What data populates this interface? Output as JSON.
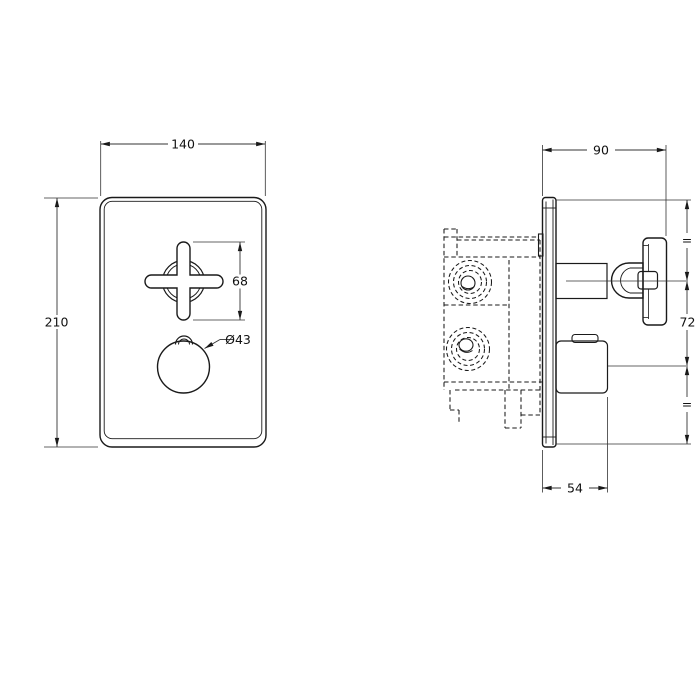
{
  "drawing": {
    "type": "technical-dimension-drawing",
    "subject": "concealed thermostatic shower valve, front and side elevation",
    "colors": {
      "background": "#ffffff",
      "line": "#1a1a1a",
      "dimension": "#333333",
      "knurl_dark": "#101010"
    },
    "front_view": {
      "dim_width": "140",
      "dim_height": "210",
      "dim_handle_height": "68",
      "dim_knob_diameter": "Ø43"
    },
    "side_view": {
      "dim_depth": "90",
      "dim_handle_centers": "72",
      "dim_knob_depth": "54",
      "dim_equal_top": "=",
      "dim_equal_bottom": "="
    }
  }
}
